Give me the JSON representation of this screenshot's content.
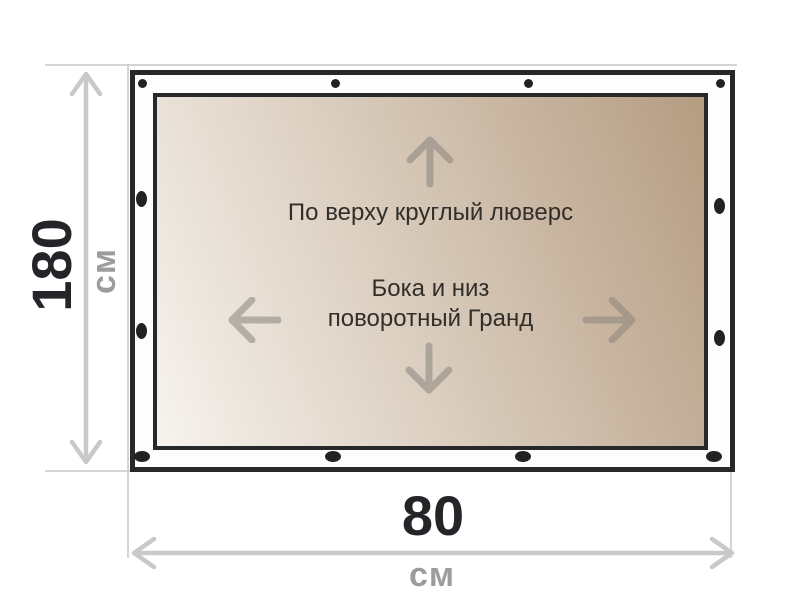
{
  "banner": {
    "top_label": "По верху круглый люверс",
    "center_label_line1": "Бока и низ",
    "center_label_line2": "поворотный Гранд",
    "grommet_counts": {
      "top": 4,
      "bottom": 4,
      "left_side": 2,
      "right_side": 2
    }
  },
  "dimensions": {
    "height_value": "180",
    "height_unit": "см",
    "width_value": "80",
    "width_unit": "см"
  },
  "icons": {
    "up": "arrow-up-icon",
    "down": "arrow-down-icon",
    "left": "arrow-left-icon",
    "right": "arrow-right-icon",
    "grommet": "grommet-dot-icon"
  },
  "colors": {
    "border": "#26282a",
    "grommet": "#202224",
    "gradient_start": "#f7f3ee",
    "gradient_end": "#b59c81",
    "dimension_line": "#c9c9c9",
    "value_text": "#232528",
    "unit_text": "#9c9c9c",
    "banner_text": "#322e2a",
    "arrow": "#8a857e"
  }
}
